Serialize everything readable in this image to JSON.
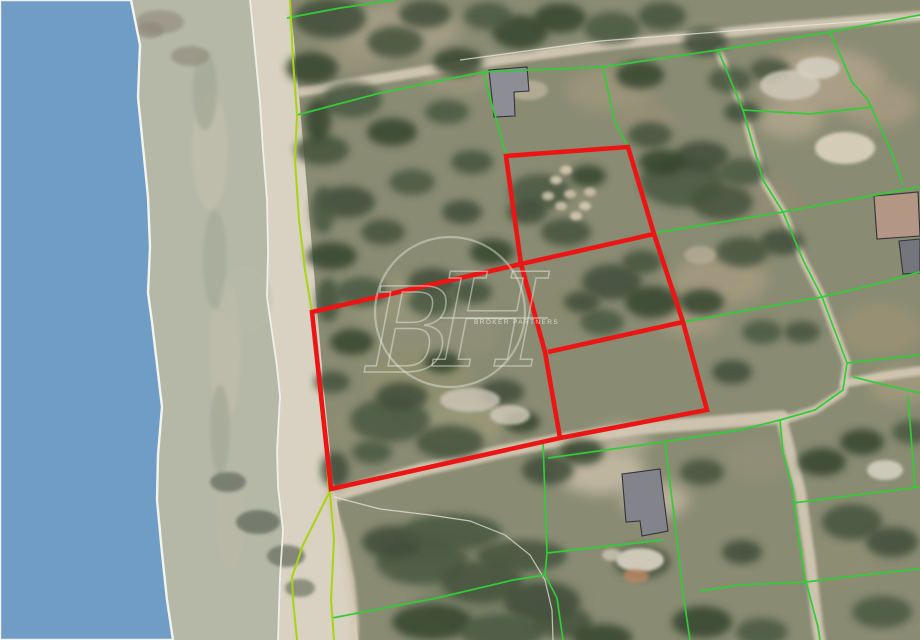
{
  "image": {
    "kind": "aerial-cadastral-photo",
    "width_px": 920,
    "height_px": 640
  },
  "colors": {
    "sea": "#6f9dc6",
    "shoreline_white": "#f2f4ef",
    "beach_dry": "#d9d1c1",
    "beach_wet": "#b3b6a5",
    "land_base": "#898b72",
    "road_sand": "#d5cab6",
    "cadastral_green": "#32cc38",
    "shore_cadastral_green": "#a8d414",
    "parcel_red": "#ec1515",
    "building_outline": "#33333a",
    "watermark": "#e9ece3"
  },
  "watermark": {
    "monogram": "BH",
    "subtext": "BROKER PARTNERS"
  },
  "map": {
    "sea_edge": [
      [
        131,
        0
      ],
      [
        140,
        45
      ],
      [
        138,
        97
      ],
      [
        143,
        147
      ],
      [
        148,
        197
      ],
      [
        150,
        247
      ],
      [
        148,
        293
      ],
      [
        152,
        322
      ],
      [
        162,
        407
      ],
      [
        158,
        455
      ],
      [
        157,
        500
      ],
      [
        162,
        553
      ],
      [
        167,
        600
      ],
      [
        173,
        640
      ]
    ],
    "beach_upper_edge": [
      [
        250,
        0
      ],
      [
        252,
        20
      ],
      [
        260,
        103
      ],
      [
        263,
        150
      ],
      [
        267,
        200
      ],
      [
        268,
        252
      ],
      [
        267,
        297
      ],
      [
        277,
        367
      ],
      [
        280,
        397
      ],
      [
        277,
        450
      ],
      [
        278,
        487
      ],
      [
        283,
        530
      ],
      [
        280,
        577
      ],
      [
        278,
        640
      ]
    ],
    "beach_land_limit": [
      [
        290,
        0
      ],
      [
        296,
        60
      ],
      [
        302,
        130
      ],
      [
        308,
        200
      ],
      [
        313,
        260
      ],
      [
        318,
        320
      ],
      [
        324,
        390
      ],
      [
        330,
        450
      ],
      [
        338,
        510
      ],
      [
        348,
        570
      ],
      [
        356,
        620
      ],
      [
        358,
        640
      ]
    ],
    "roads": [
      {
        "name": "coast-road",
        "width": 13,
        "points": [
          [
            328,
            497
          ],
          [
            420,
            470
          ],
          [
            500,
            452
          ],
          [
            560,
            440
          ],
          [
            640,
            428
          ],
          [
            720,
            422
          ],
          [
            782,
            417
          ]
        ]
      },
      {
        "name": "south-road",
        "width": 11,
        "points": [
          [
            783,
            425
          ],
          [
            800,
            490
          ],
          [
            810,
            560
          ],
          [
            818,
            630
          ],
          [
            820,
            640
          ]
        ]
      },
      {
        "name": "north-track",
        "width": 8,
        "points": [
          [
            718,
            50
          ],
          [
            743,
            110
          ],
          [
            763,
            180
          ],
          [
            783,
            212
          ],
          [
            803,
            260
          ],
          [
            822,
            297
          ],
          [
            847,
            363
          ],
          [
            843,
            392
          ],
          [
            815,
            410
          ],
          [
            783,
            420
          ]
        ]
      },
      {
        "name": "east-road",
        "width": 9,
        "points": [
          [
            845,
            383
          ],
          [
            890,
            375
          ],
          [
            920,
            371
          ]
        ]
      },
      {
        "name": "top-road",
        "width": 10,
        "points": [
          [
            300,
            92
          ],
          [
            430,
            70
          ],
          [
            600,
            46
          ],
          [
            780,
            27
          ],
          [
            920,
            16
          ]
        ]
      },
      {
        "name": "beach-south-path",
        "width": 9,
        "points": [
          [
            330,
            500
          ],
          [
            342,
            540
          ],
          [
            350,
            580
          ],
          [
            354,
            620
          ],
          [
            354,
            640
          ]
        ]
      }
    ],
    "white_lines": [
      {
        "name": "top-road-edge",
        "points": [
          [
            460,
            60
          ],
          [
            600,
            41
          ],
          [
            770,
            28
          ],
          [
            920,
            17
          ]
        ]
      },
      {
        "name": "field-curve-edge",
        "points": [
          [
            334,
            497
          ],
          [
            380,
            509
          ],
          [
            430,
            515
          ],
          [
            470,
            521
          ],
          [
            505,
            535
          ],
          [
            530,
            555
          ],
          [
            545,
            580
          ],
          [
            552,
            610
          ],
          [
            553,
            640
          ]
        ]
      }
    ],
    "cadastral_lines": [
      {
        "points": [
          [
            297,
            115
          ],
          [
            380,
            93
          ],
          [
            483,
            72
          ],
          [
            603,
            67
          ],
          [
            718,
            50
          ],
          [
            830,
            32
          ],
          [
            920,
            15
          ]
        ]
      },
      {
        "points": [
          [
            483,
            72
          ],
          [
            500,
            133
          ],
          [
            506,
            156
          ]
        ]
      },
      {
        "points": [
          [
            603,
            67
          ],
          [
            615,
            123
          ],
          [
            628,
            147
          ]
        ]
      },
      {
        "points": [
          [
            718,
            50
          ],
          [
            743,
            110
          ],
          [
            763,
            180
          ],
          [
            783,
            212
          ],
          [
            803,
            260
          ],
          [
            822,
            297
          ],
          [
            847,
            363
          ],
          [
            843,
            390
          ],
          [
            815,
            410
          ],
          [
            780,
            420
          ],
          [
            740,
            430
          ],
          [
            663,
            442
          ],
          [
            620,
            448
          ],
          [
            548,
            458
          ]
        ]
      },
      {
        "points": [
          [
            543,
            441
          ],
          [
            547,
            553
          ],
          [
            545,
            575
          ],
          [
            557,
            598
          ],
          [
            563,
            640
          ]
        ]
      },
      {
        "points": [
          [
            332,
            618
          ],
          [
            437,
            598
          ],
          [
            513,
            580
          ],
          [
            545,
            575
          ]
        ]
      },
      {
        "points": [
          [
            547,
            553
          ],
          [
            600,
            547
          ],
          [
            663,
            540
          ]
        ]
      },
      {
        "points": [
          [
            665,
            443
          ],
          [
            677,
            540
          ],
          [
            683,
            593
          ],
          [
            690,
            640
          ]
        ]
      },
      {
        "points": [
          [
            655,
            233
          ],
          [
            783,
            212
          ],
          [
            870,
            196
          ],
          [
            920,
            187
          ]
        ]
      },
      {
        "points": [
          [
            683,
            322
          ],
          [
            760,
            308
          ],
          [
            822,
            297
          ],
          [
            880,
            283
          ],
          [
            920,
            272
          ]
        ]
      },
      {
        "points": [
          [
            780,
            420
          ],
          [
            783,
            453
          ],
          [
            792,
            485
          ],
          [
            798,
            533
          ],
          [
            805,
            578
          ],
          [
            818,
            627
          ],
          [
            820,
            640
          ]
        ]
      },
      {
        "points": [
          [
            793,
            503
          ],
          [
            880,
            492
          ],
          [
            920,
            487
          ]
        ]
      },
      {
        "points": [
          [
            700,
            591
          ],
          [
            740,
            585
          ],
          [
            806,
            582
          ],
          [
            880,
            573
          ],
          [
            920,
            569
          ]
        ]
      },
      {
        "points": [
          [
            847,
            363
          ],
          [
            883,
            359
          ],
          [
            920,
            355
          ]
        ]
      },
      {
        "points": [
          [
            853,
            377
          ],
          [
            890,
            386
          ],
          [
            920,
            393
          ]
        ]
      },
      {
        "points": [
          [
            908,
            396
          ],
          [
            915,
            487
          ]
        ]
      },
      {
        "points": [
          [
            830,
            32
          ],
          [
            852,
            82
          ],
          [
            868,
            100
          ],
          [
            877,
            120
          ],
          [
            892,
            153
          ],
          [
            903,
            185
          ]
        ]
      },
      {
        "points": [
          [
            743,
            110
          ],
          [
            810,
            114
          ],
          [
            872,
            107
          ]
        ]
      },
      {
        "points": [
          [
            287,
            18
          ],
          [
            340,
            8
          ],
          [
            395,
            0
          ]
        ]
      }
    ],
    "shore_cadastral_lines": [
      {
        "points": [
          [
            290,
            0
          ],
          [
            293,
            60
          ],
          [
            297,
            115
          ],
          [
            295,
            160
          ],
          [
            299,
            220
          ],
          [
            305,
            270
          ],
          [
            312,
            312
          ],
          [
            320,
            400
          ],
          [
            326,
            450
          ],
          [
            329,
            493
          ],
          [
            303,
            545
          ],
          [
            292,
            577
          ],
          [
            293,
            600
          ],
          [
            297,
            640
          ]
        ]
      },
      {
        "points": [
          [
            330,
            493
          ],
          [
            334,
            540
          ],
          [
            331,
            600
          ],
          [
            334,
            640
          ]
        ]
      }
    ],
    "red_parcels": {
      "outline": [
        [
          312,
          312
        ],
        [
          521,
          264
        ],
        [
          506,
          156
        ],
        [
          628,
          147
        ],
        [
          654,
          234
        ],
        [
          683,
          322
        ],
        [
          707,
          410
        ],
        [
          560,
          438
        ],
        [
          331,
          489
        ]
      ],
      "dividers": [
        [
          [
            521,
            264
          ],
          [
            654,
            234
          ]
        ],
        [
          [
            521,
            264
          ],
          [
            545,
            352
          ],
          [
            560,
            438
          ]
        ],
        [
          [
            548,
            352
          ],
          [
            683,
            322
          ]
        ]
      ]
    },
    "buildings": [
      {
        "name": "house-north",
        "fill": "#8d8d95",
        "points": [
          [
            489,
            70
          ],
          [
            527,
            67
          ],
          [
            529,
            91
          ],
          [
            514,
            92
          ],
          [
            515,
            116
          ],
          [
            494,
            117
          ]
        ]
      },
      {
        "name": "house-south",
        "fill": "#83838b",
        "points": [
          [
            622,
            474
          ],
          [
            660,
            469
          ],
          [
            668,
            531
          ],
          [
            642,
            536
          ],
          [
            640,
            521
          ],
          [
            626,
            522
          ]
        ]
      },
      {
        "name": "house-east-tan",
        "fill": "#b39683",
        "points": [
          [
            874,
            196
          ],
          [
            918,
            192
          ],
          [
            920,
            236
          ],
          [
            877,
            239
          ]
        ]
      },
      {
        "name": "house-east-dark",
        "fill": "#75757c",
        "points": [
          [
            899,
            241
          ],
          [
            920,
            239
          ],
          [
            920,
            273
          ],
          [
            903,
            274
          ]
        ]
      }
    ]
  }
}
